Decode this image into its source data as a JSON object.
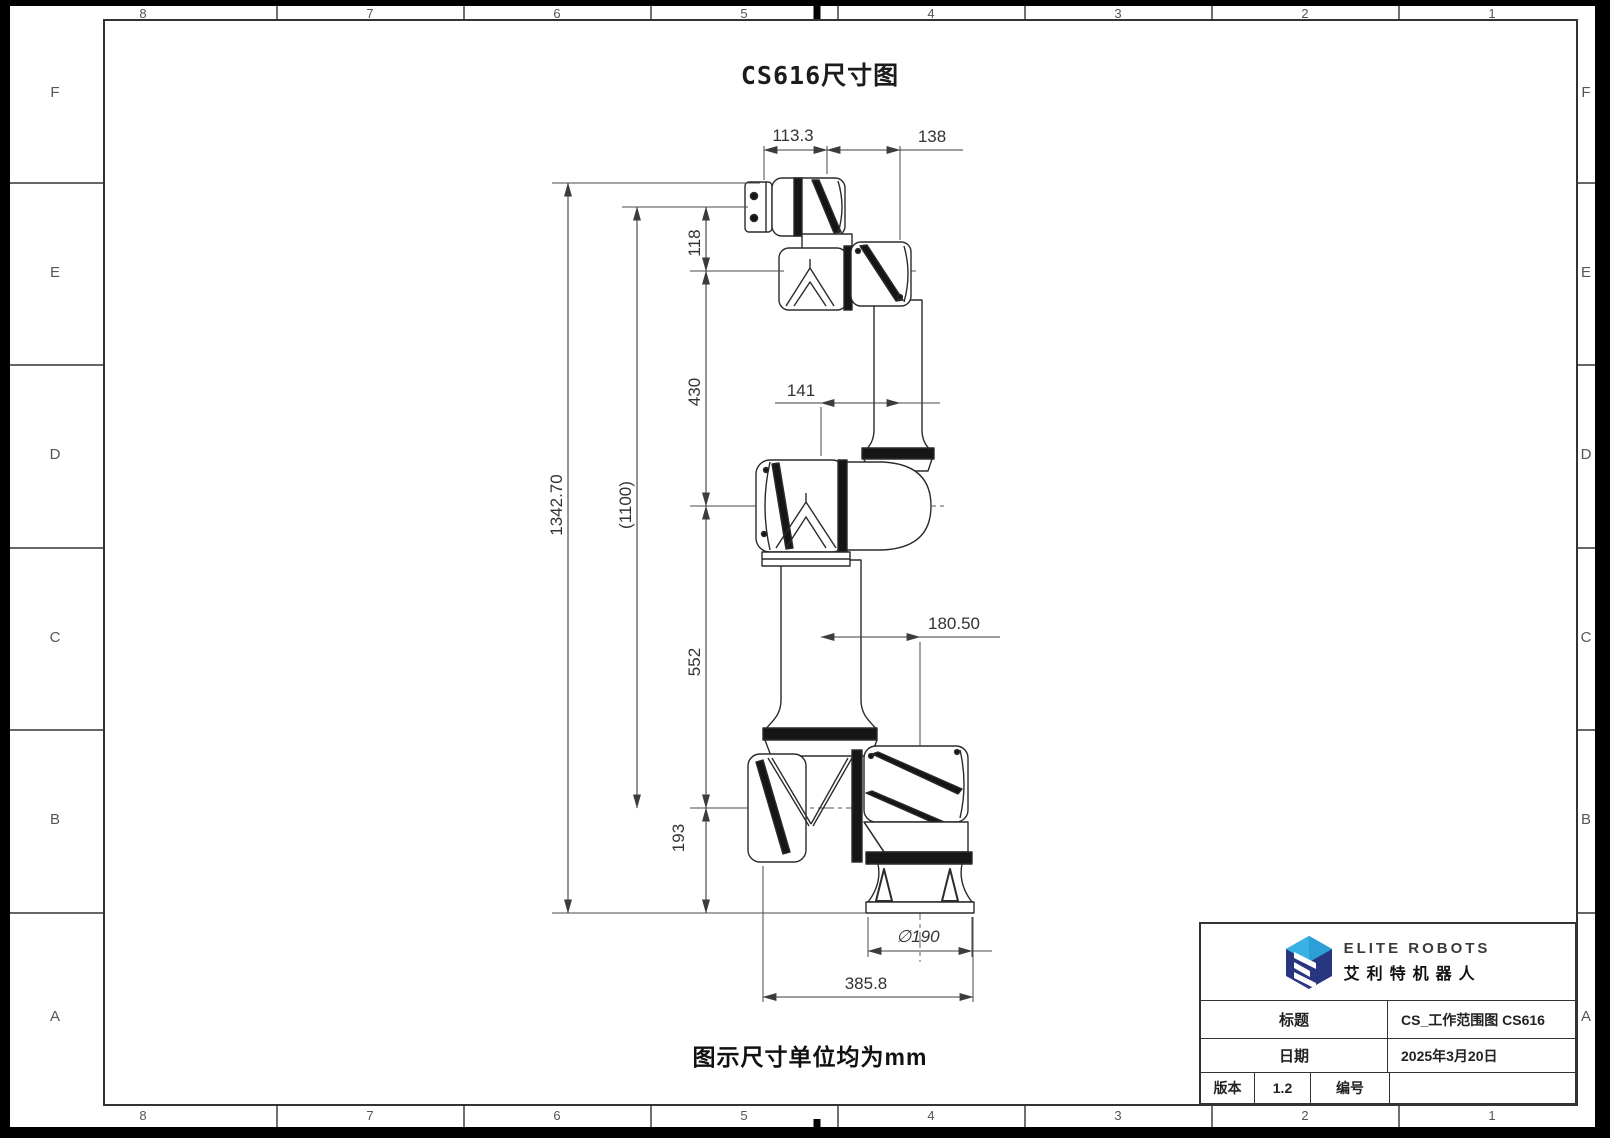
{
  "sheet": {
    "title": "CS616尺寸图",
    "note": "图示尺寸单位均为mm",
    "zone_columns": [
      "8",
      "7",
      "6",
      "5",
      "4",
      "3",
      "2",
      "1"
    ],
    "zone_rows": [
      "F",
      "E",
      "D",
      "C",
      "B",
      "A"
    ]
  },
  "dims": {
    "top_flange_width": "113.3",
    "wrist_span": "138",
    "flange_drop": "118",
    "forearm_length": "430",
    "overall_height": "1342.70",
    "reference_height": "(1100)",
    "upper_arm_length": "552",
    "elbow_offset": "141",
    "shoulder_offset": "180.50",
    "base_height": "193",
    "base_diameter": "∅190",
    "base_width": "385.8"
  },
  "title_block": {
    "brand": "ELITE ROBOTS",
    "brand_cn": "艾利特机器人",
    "title_label": "标题",
    "title_value": "CS_工作范围图 CS616",
    "date_label": "日期",
    "date_value": "2025年3月20日",
    "version_label": "版本",
    "version_value": "1.2",
    "number_label": "编号",
    "number_value": ""
  },
  "colors": {
    "line": "#3c3c3c",
    "logo_light_blue": "#38b1e4",
    "logo_navy": "#27367f"
  }
}
